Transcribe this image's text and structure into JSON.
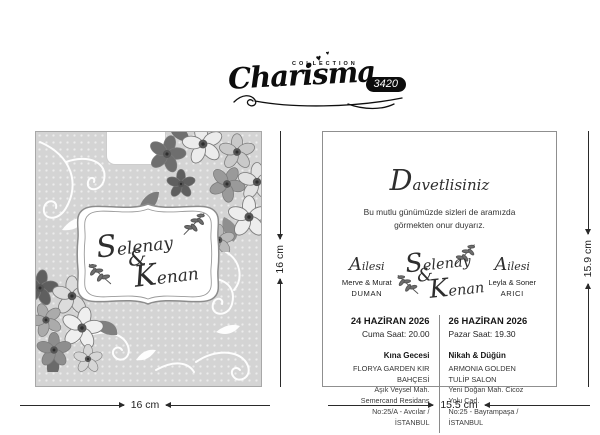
{
  "logo": {
    "brand": "Charisma",
    "collection": "COLLECTION",
    "model": "3420"
  },
  "icons": {
    "heart": "♥"
  },
  "front_panel": {
    "couple": {
      "first": "Selenay",
      "amp": "&",
      "second": "Kenan"
    }
  },
  "inner_panel": {
    "greeting": "Davetlisiniz",
    "message_line1": "Bu mutlu günümüzde sizleri de aramızda",
    "message_line2": "görmekten onur duyarız.",
    "family_left": {
      "label": "Ailesi",
      "names": "Merve & Murat",
      "surname": "DUMAN"
    },
    "family_right": {
      "label": "Ailesi",
      "names": "Leyla & Soner",
      "surname": "ARICI"
    },
    "couple": {
      "first": "Selenay",
      "amp": "&",
      "second": "Kenan"
    },
    "event_left": {
      "date": "24 HAZİRAN 2026",
      "time": "Cuma Saat: 20.00",
      "title": "Kına Gecesi",
      "venue": "FLORYA GARDEN KIR BAHÇESİ",
      "address1": "Aşık Veysel Mah. Semercand Residans",
      "address2": "No:25/A - Avcılar / İSTANBUL"
    },
    "event_right": {
      "date": "26 HAZİRAN 2026",
      "time": "Pazar Saat: 19.30",
      "title": "Nikah & Düğün",
      "venue": "ARMONIA GOLDEN TULİP SALON",
      "address1": "Yeni Doğan Mah. Cicoz Yolu Cad.",
      "address2": "No:25 - Bayrampaşa / İSTANBUL"
    }
  },
  "dimensions": {
    "front_width": "16 cm",
    "front_height": "16 cm",
    "inner_width": "15.5 cm",
    "inner_height": "15.9 cm"
  },
  "colors": {
    "panel_bg": "#d4d4d4",
    "badge_bg": "#0d0d0d",
    "text": "#222222"
  }
}
